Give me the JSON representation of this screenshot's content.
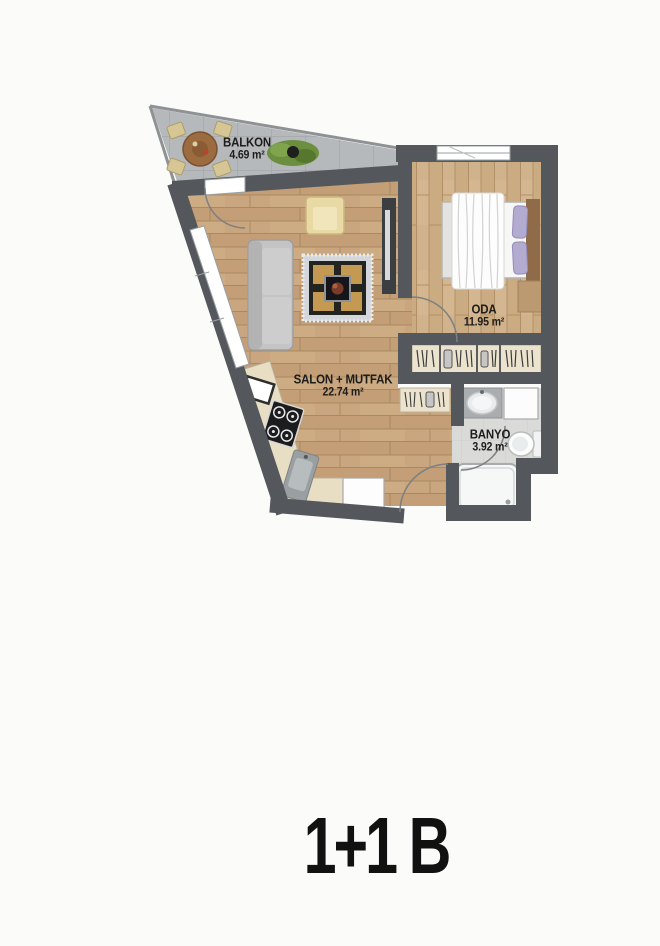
{
  "title": "1+1 B",
  "rooms": {
    "balcony": {
      "label": "BALKON",
      "area": "4.69 m²"
    },
    "living_kitchen": {
      "label": "SALON + MUTFAK",
      "area": "22.74 m²"
    },
    "bedroom": {
      "label": "ODA",
      "area": "11.95 m²"
    },
    "bathroom": {
      "label": "BANYO",
      "area": "3.92 m²"
    }
  },
  "colors": {
    "wall": "#54575b",
    "wood_living": "#c9a67f",
    "wood_bedroom": "#d0b38c",
    "balcony_tile": "#b6b9bb",
    "bathroom_tile": "#dadbd9",
    "wardrobe_fill": "#ebe3cd",
    "pillow_accent": "#b3abd0",
    "label_text": "#1d1d1b"
  }
}
